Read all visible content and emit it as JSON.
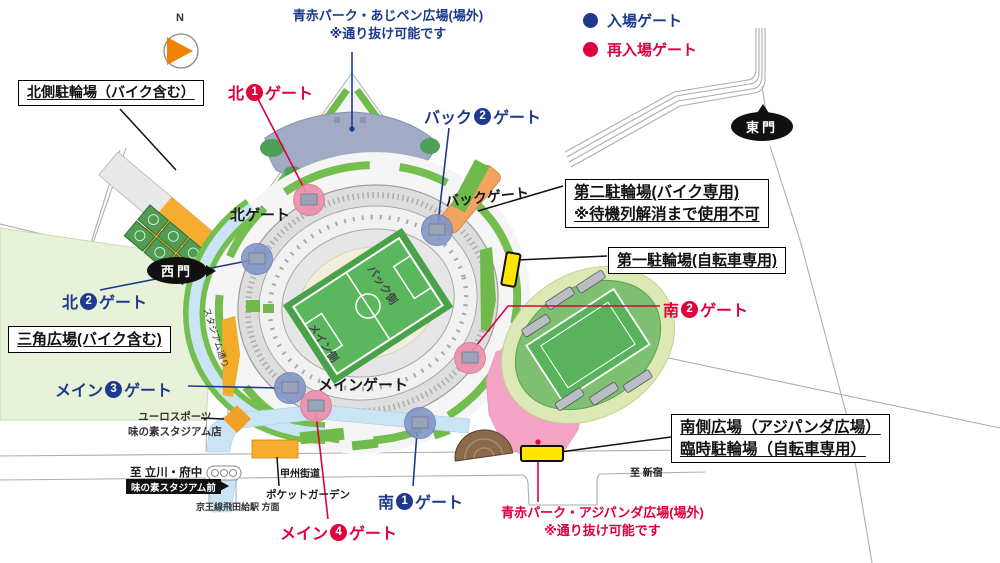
{
  "colors": {
    "entry_blue": "#1d3a8c",
    "reentry_red": "#e0003c",
    "parking_orange": "#f6ad2f",
    "marker_yellow": "#ffe600",
    "plaza_pink": "#f3a3c3",
    "park_bluegray": "#a2abc6",
    "compass_orange": "#f08300"
  },
  "compass": {
    "n": "N"
  },
  "legend": {
    "entry": {
      "label": "入場ゲート"
    },
    "reentry": {
      "label": "再入場ゲート"
    }
  },
  "notes": {
    "north_park": {
      "line1": "青赤パーク・あじペン広場(場外)",
      "line2": "※通り抜け可能です"
    },
    "south_park": {
      "line1": "青赤パーク・アジパンダ広場(場外)",
      "line2": "※通り抜け可能です"
    }
  },
  "boxes": {
    "north_bike": {
      "text": "北側駐輪場（バイク含む）"
    },
    "second_bike": {
      "line1": "第二駐輪場(バイク専用)",
      "line2": "※待機列解消まで使用不可"
    },
    "first_bike": {
      "text": "第一駐輪場(自転車専用)"
    },
    "triangle_plaza": {
      "text": "三角広場(バイク含む)"
    },
    "south_plaza": {
      "line1": "南側広場（アジパンダ広場）",
      "line2": "臨時駐輪場（自転車専用）"
    }
  },
  "gates": {
    "north1": {
      "pre": "北",
      "num": "1",
      "post": "ゲート",
      "type": "reentry"
    },
    "north2": {
      "pre": "北",
      "num": "2",
      "post": "ゲート",
      "type": "entry"
    },
    "back2": {
      "pre": "バック",
      "num": "2",
      "post": "ゲート",
      "type": "entry"
    },
    "main3": {
      "pre": "メイン",
      "num": "3",
      "post": "ゲート",
      "type": "entry"
    },
    "main4": {
      "pre": "メイン",
      "num": "4",
      "post": "ゲート",
      "type": "reentry"
    },
    "south1": {
      "pre": "南",
      "num": "1",
      "post": "ゲート",
      "type": "entry"
    },
    "south2": {
      "pre": "南",
      "num": "2",
      "post": "ゲート",
      "type": "reentry"
    }
  },
  "labels": {
    "north_gate": "北ゲート",
    "back_gate": "バックゲート",
    "main_gate": "メインゲート",
    "east_gate_tag": "東門",
    "west_gate_tag": "西門",
    "bus_stop_tag": "味の素スタジアム前",
    "back_side": "バック側",
    "main_side": "メイン側",
    "stadium_street": "スタジアム通り",
    "koshu_kaido": "甲州街道",
    "to_tachikawa": "至 立川・府中",
    "to_shinjuku": "至 新宿",
    "keio_line": "京王線飛田給駅 方面",
    "euro_sports_line1": "ユーロスポーツ",
    "euro_sports_line2": "味の素スタジアム店",
    "pocket_garden": "ポケットガーデン"
  }
}
